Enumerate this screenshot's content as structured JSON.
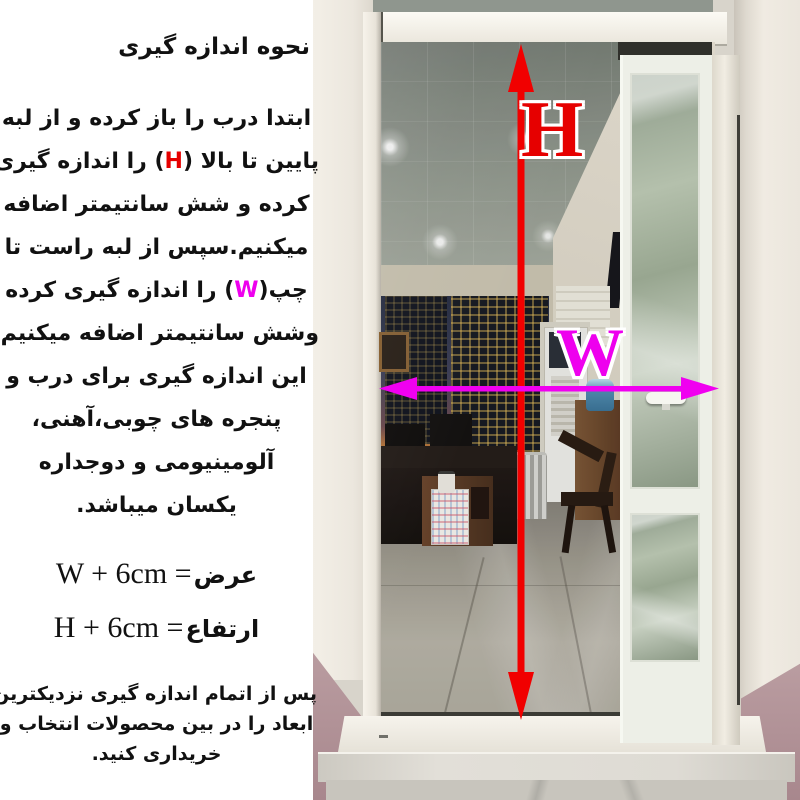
{
  "colors": {
    "h_red": "#e60000",
    "w_magenta": "#ee00ee",
    "arrow_red": "#f10000",
    "arrow_magenta": "#f000f0",
    "text": "#111111",
    "panel_bg": "#ffffff"
  },
  "instructions": {
    "title": "نحوه اندازه گیری",
    "paragraph_lines": [
      {
        "segments": [
          {
            "text": "ابتدا درب را باز کرده و از لبه"
          }
        ]
      },
      {
        "segments": [
          {
            "text": "پایین تا بالا ("
          },
          {
            "text": "H",
            "color": "#e60000"
          },
          {
            "text": ") را اندازه گیری"
          }
        ]
      },
      {
        "segments": [
          {
            "text": "کرده و شش سانتیمتر اضافه"
          }
        ]
      },
      {
        "segments": [
          {
            "text": "میکنیم.سپس از لبه راست تا"
          }
        ]
      },
      {
        "segments": [
          {
            "text": "چپ("
          },
          {
            "text": "W",
            "color": "#ee00ee"
          },
          {
            "text": ") را اندازه گیری کرده"
          }
        ]
      },
      {
        "segments": [
          {
            "text": "وشش سانتیمتر اضافه میکنیم."
          }
        ]
      },
      {
        "segments": [
          {
            "text": "این اندازه گیری برای درب و"
          }
        ]
      },
      {
        "segments": [
          {
            "text": "پنجره های چوبی،آهنی،"
          }
        ]
      },
      {
        "segments": [
          {
            "text": "آلومینیومی و دوجداره"
          }
        ]
      },
      {
        "segments": [
          {
            "text": "یکسان میباشد."
          }
        ]
      }
    ],
    "formulas": {
      "width": {
        "latin": "W + 6cm =",
        "label": "عرض"
      },
      "height": {
        "latin": "H + 6cm =",
        "label": "ارتفاع"
      }
    },
    "note_lines": [
      "پس از اتمام اندازه گیری نزدیکترین",
      "ابعاد را در بین محصولات انتخاب و",
      "خریداری کنید."
    ]
  },
  "photo": {
    "h_label": "H",
    "w_label": "W"
  }
}
